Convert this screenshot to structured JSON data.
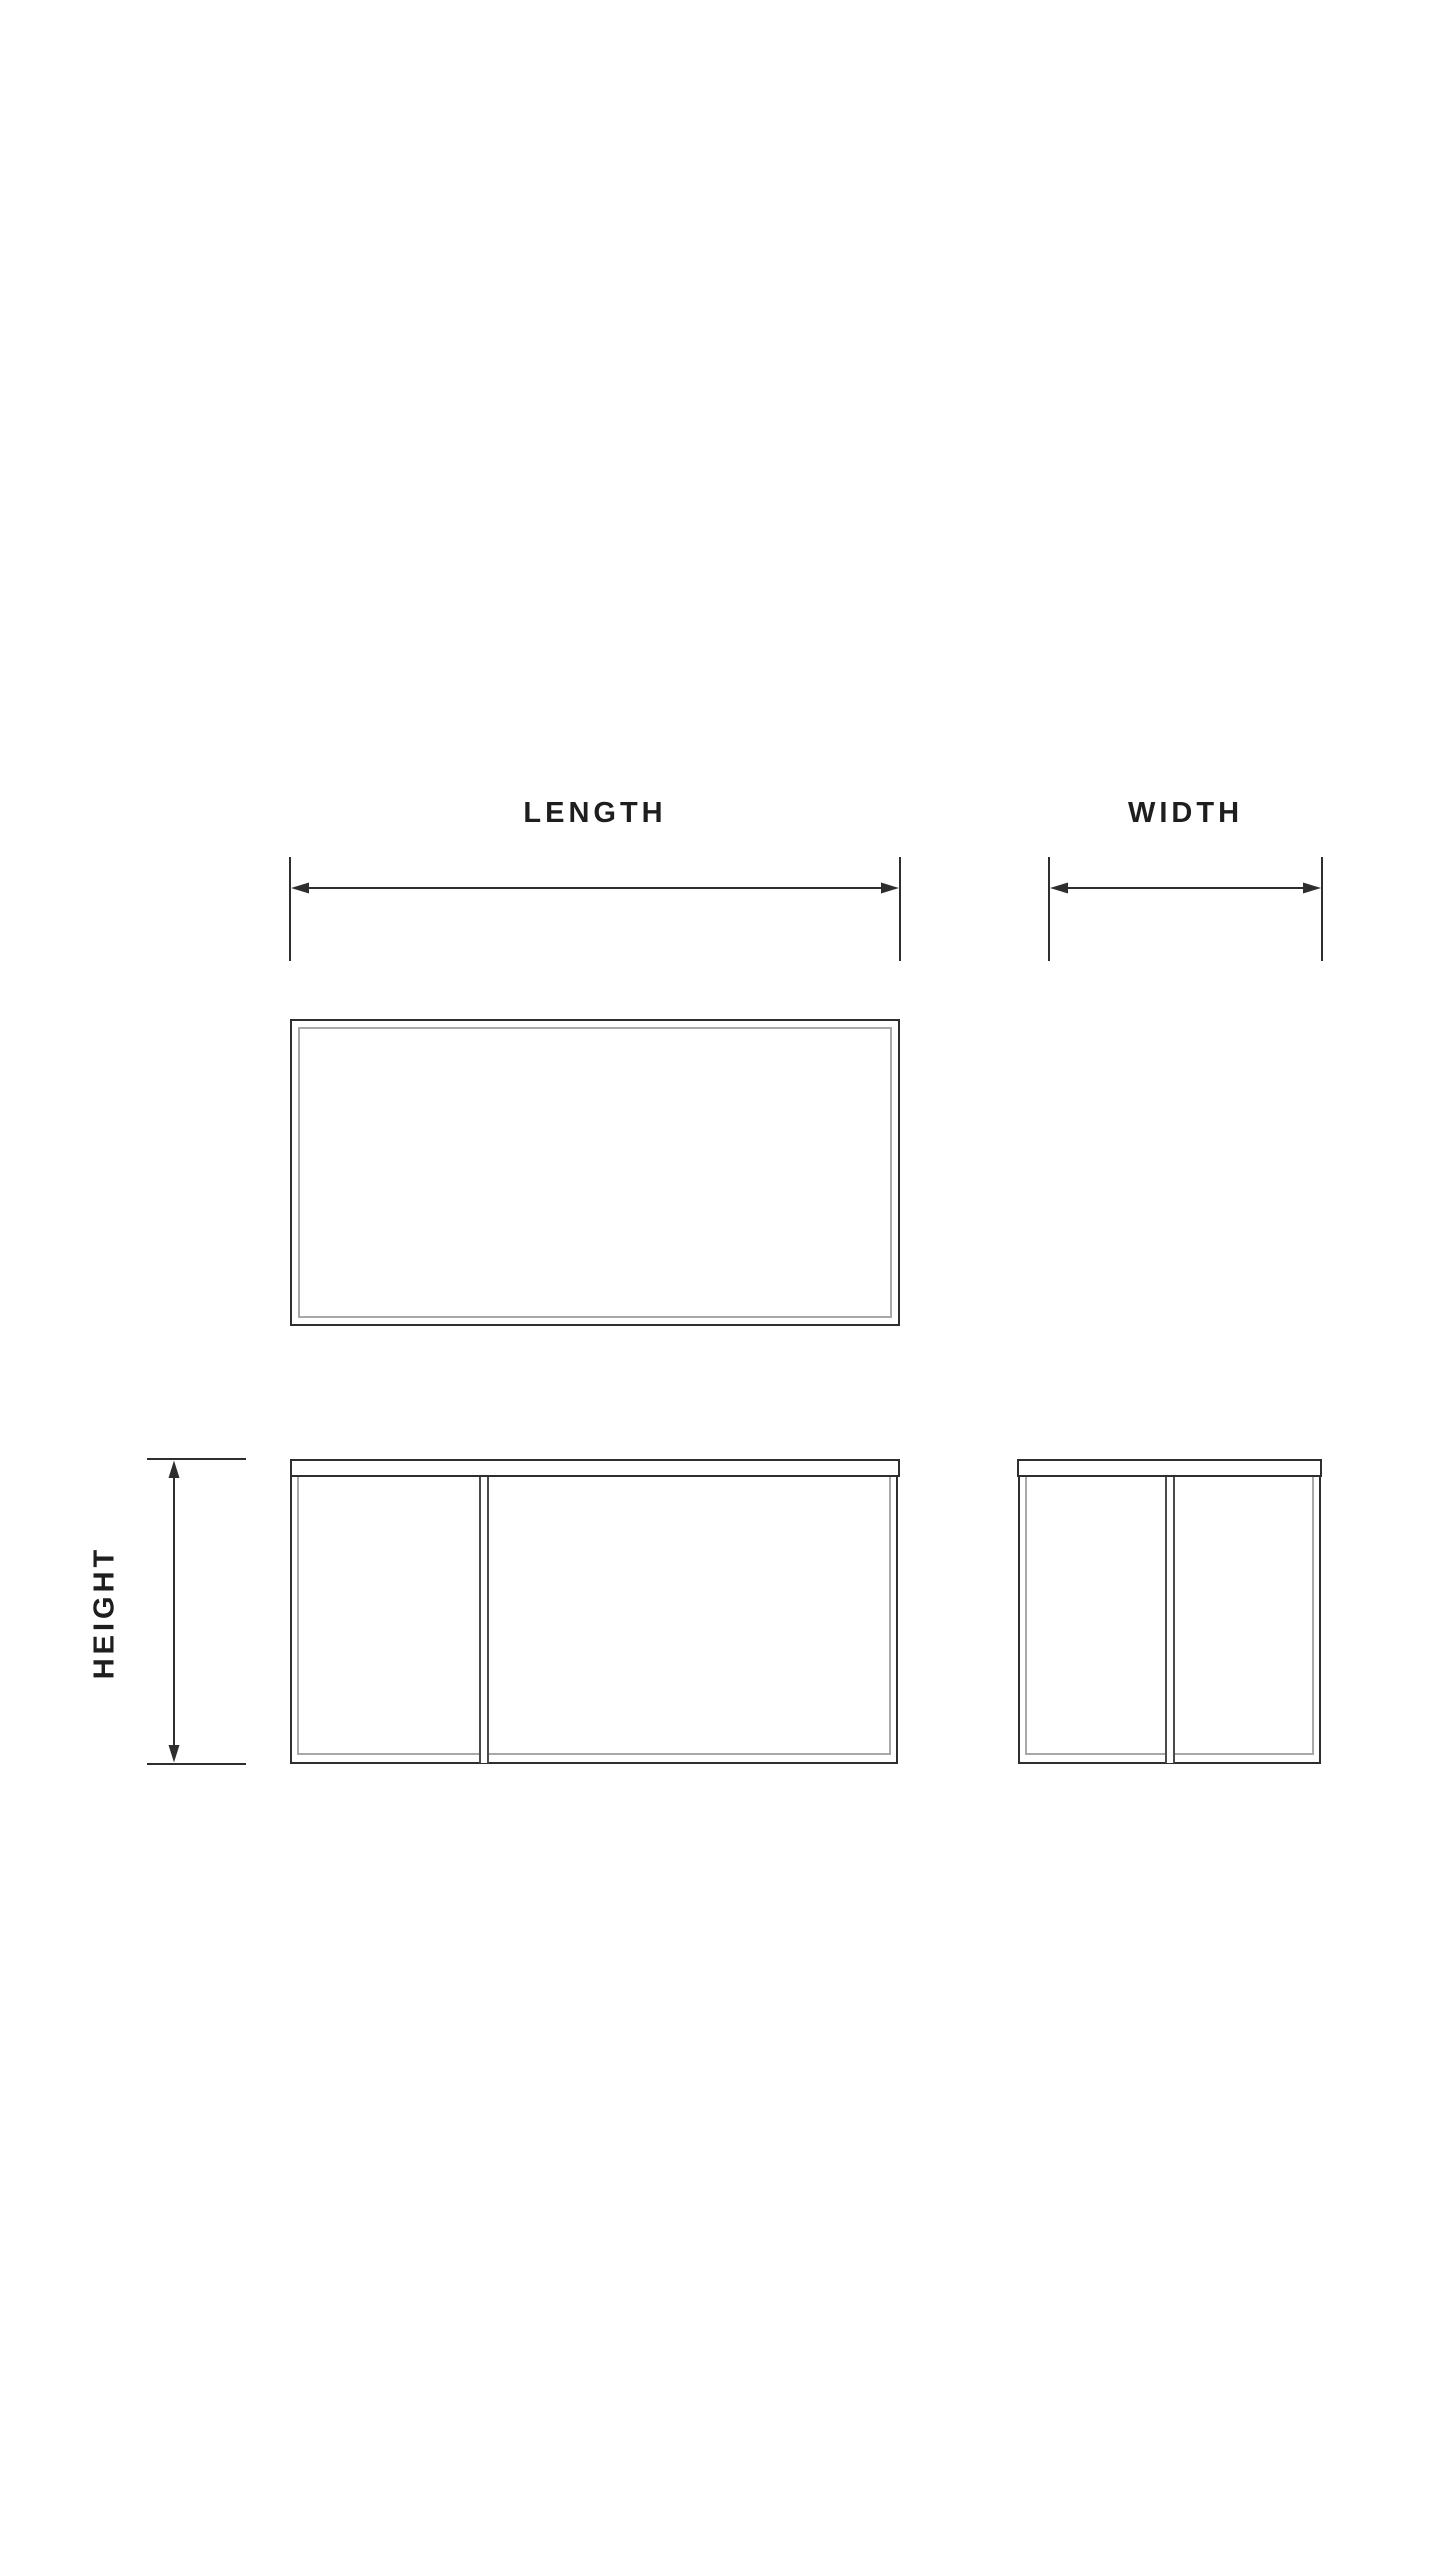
{
  "diagram": {
    "labels": {
      "length": "LENGTH",
      "width": "WIDTH",
      "height": "HEIGHT"
    },
    "colors": {
      "background": "#ffffff",
      "line": "#2e2e2e",
      "line_mid": "#4a4a4a",
      "line_inner": "#a8a8a8",
      "text": "#1e1e1e"
    }
  }
}
